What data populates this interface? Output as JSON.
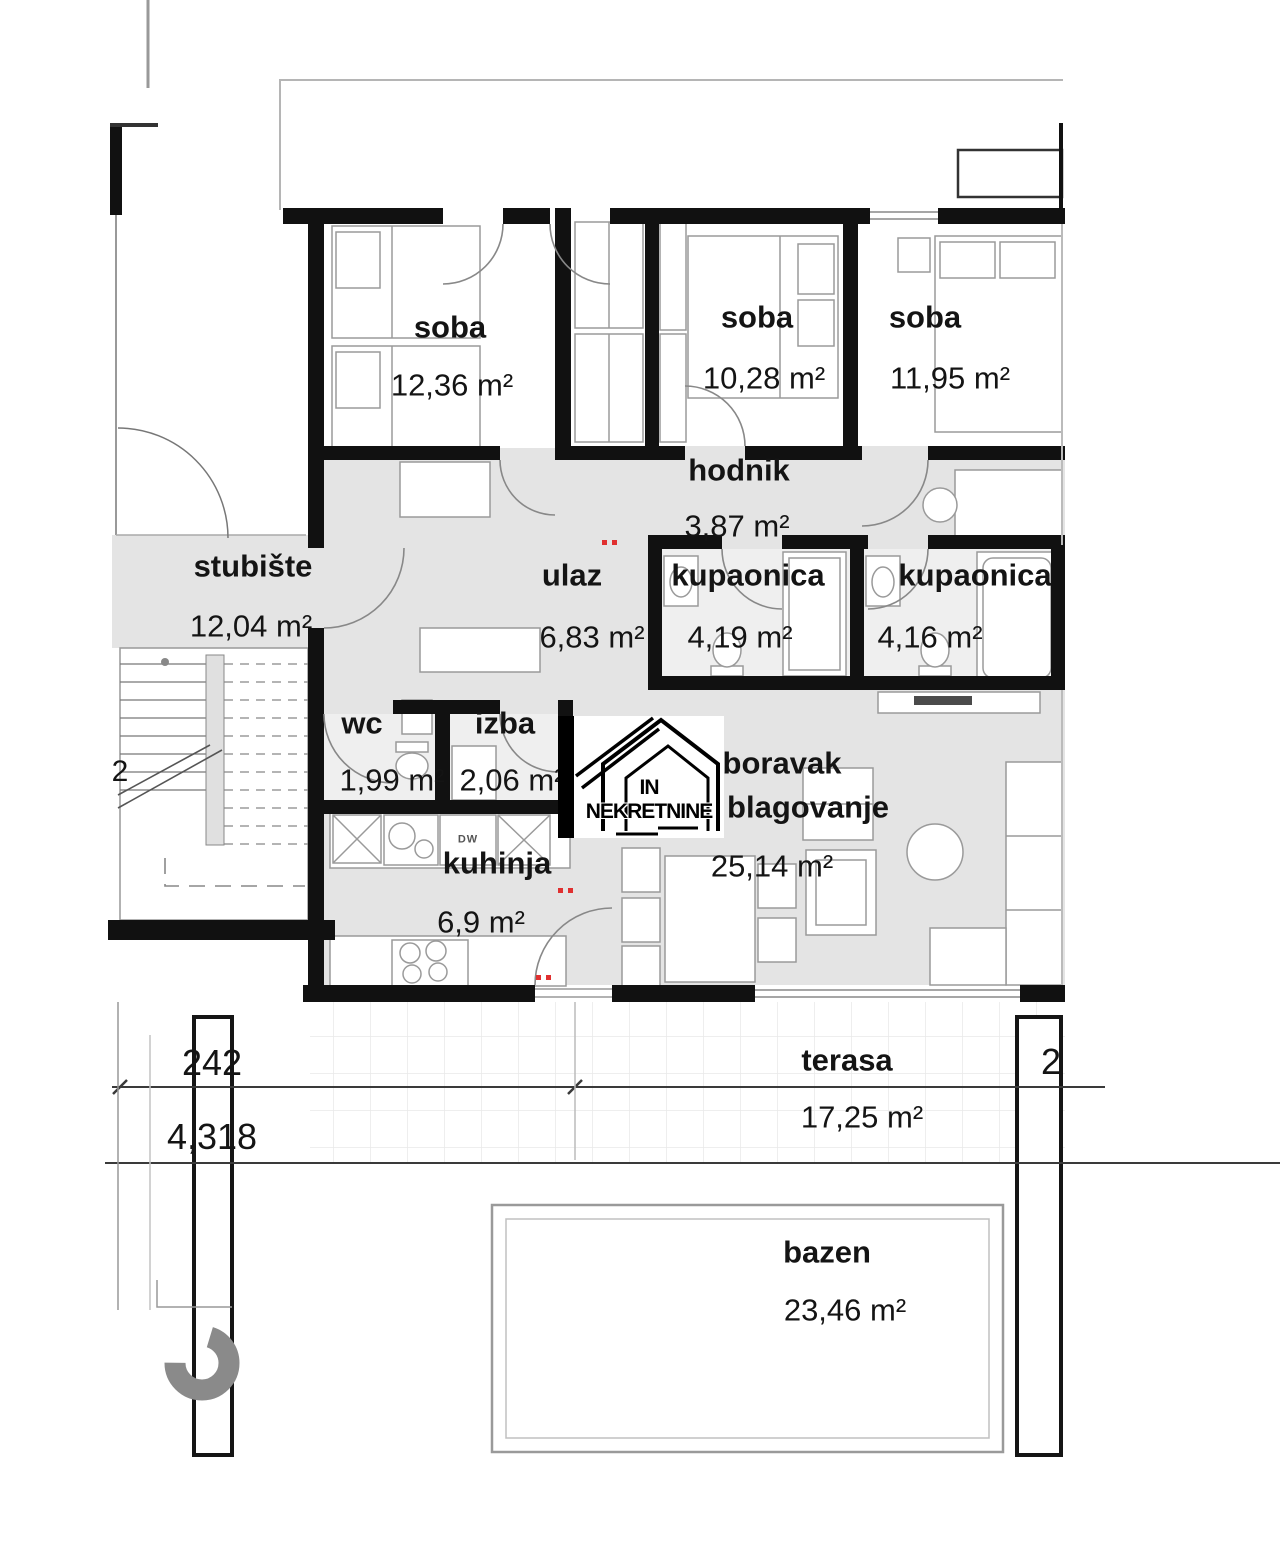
{
  "watermark": {
    "text": "IN NEKRETNINE"
  },
  "rooms": [
    {
      "name": "soba",
      "area": "12,36 m²"
    },
    {
      "name": "soba",
      "area": "10,28 m²"
    },
    {
      "name": "soba",
      "area": "11,95 m²"
    },
    {
      "name": "hodnik",
      "area": "3,87 m²"
    },
    {
      "name": "stubište",
      "area": "12,04 m²"
    },
    {
      "name": "ulaz",
      "area": "6,83 m²"
    },
    {
      "name": "kupaonica",
      "area": "4,19 m²"
    },
    {
      "name": "kupaonica",
      "area": "4,16 m²"
    },
    {
      "name": "wc",
      "area": "1,99 m²"
    },
    {
      "name": "izba",
      "area": "2,06 m²"
    },
    {
      "name": "kuhinja",
      "area": "6,9 m²"
    },
    {
      "name": "boravak",
      "name2": "blagovanje",
      "area": "25,14 m²"
    },
    {
      "name": "terasa",
      "area": "17,25 m²"
    },
    {
      "name": "bazen",
      "area": "23,46 m²"
    }
  ],
  "dimensions": {
    "width_top": "242",
    "width_bottom": "4,318",
    "stair_floor": "2",
    "right_edge": "2"
  },
  "appliances": {
    "dishwasher": "DW"
  }
}
